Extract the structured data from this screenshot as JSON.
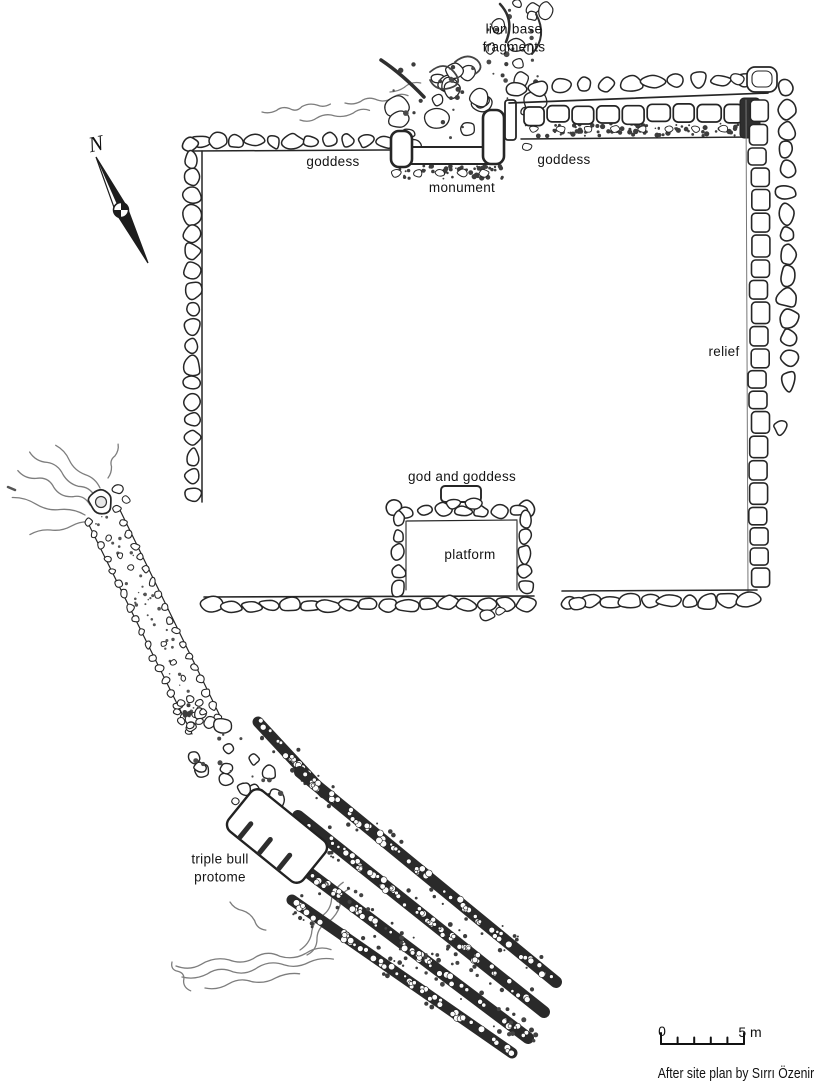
{
  "document": {
    "type": "archaeological site plan"
  },
  "labels": {
    "lion_base_fragments": "lion base\nfragments",
    "goddess_left": "goddess",
    "monument": "monument",
    "goddess_right": "goddess",
    "relief": "relief",
    "god_and_goddess": "god and goddess",
    "platform": "platform",
    "triple_bull_protome": "triple bull\nprotome"
  },
  "north_indicator": {
    "letter": "N"
  },
  "scale_bar": {
    "zero_label": "0",
    "end_label": "5 m"
  },
  "attribution": {
    "text": "After site plan by Sırrı Özenir"
  },
  "colors": {
    "ink": "#262626",
    "paper": "#ffffff",
    "squiggle": "#7d7d7d"
  }
}
